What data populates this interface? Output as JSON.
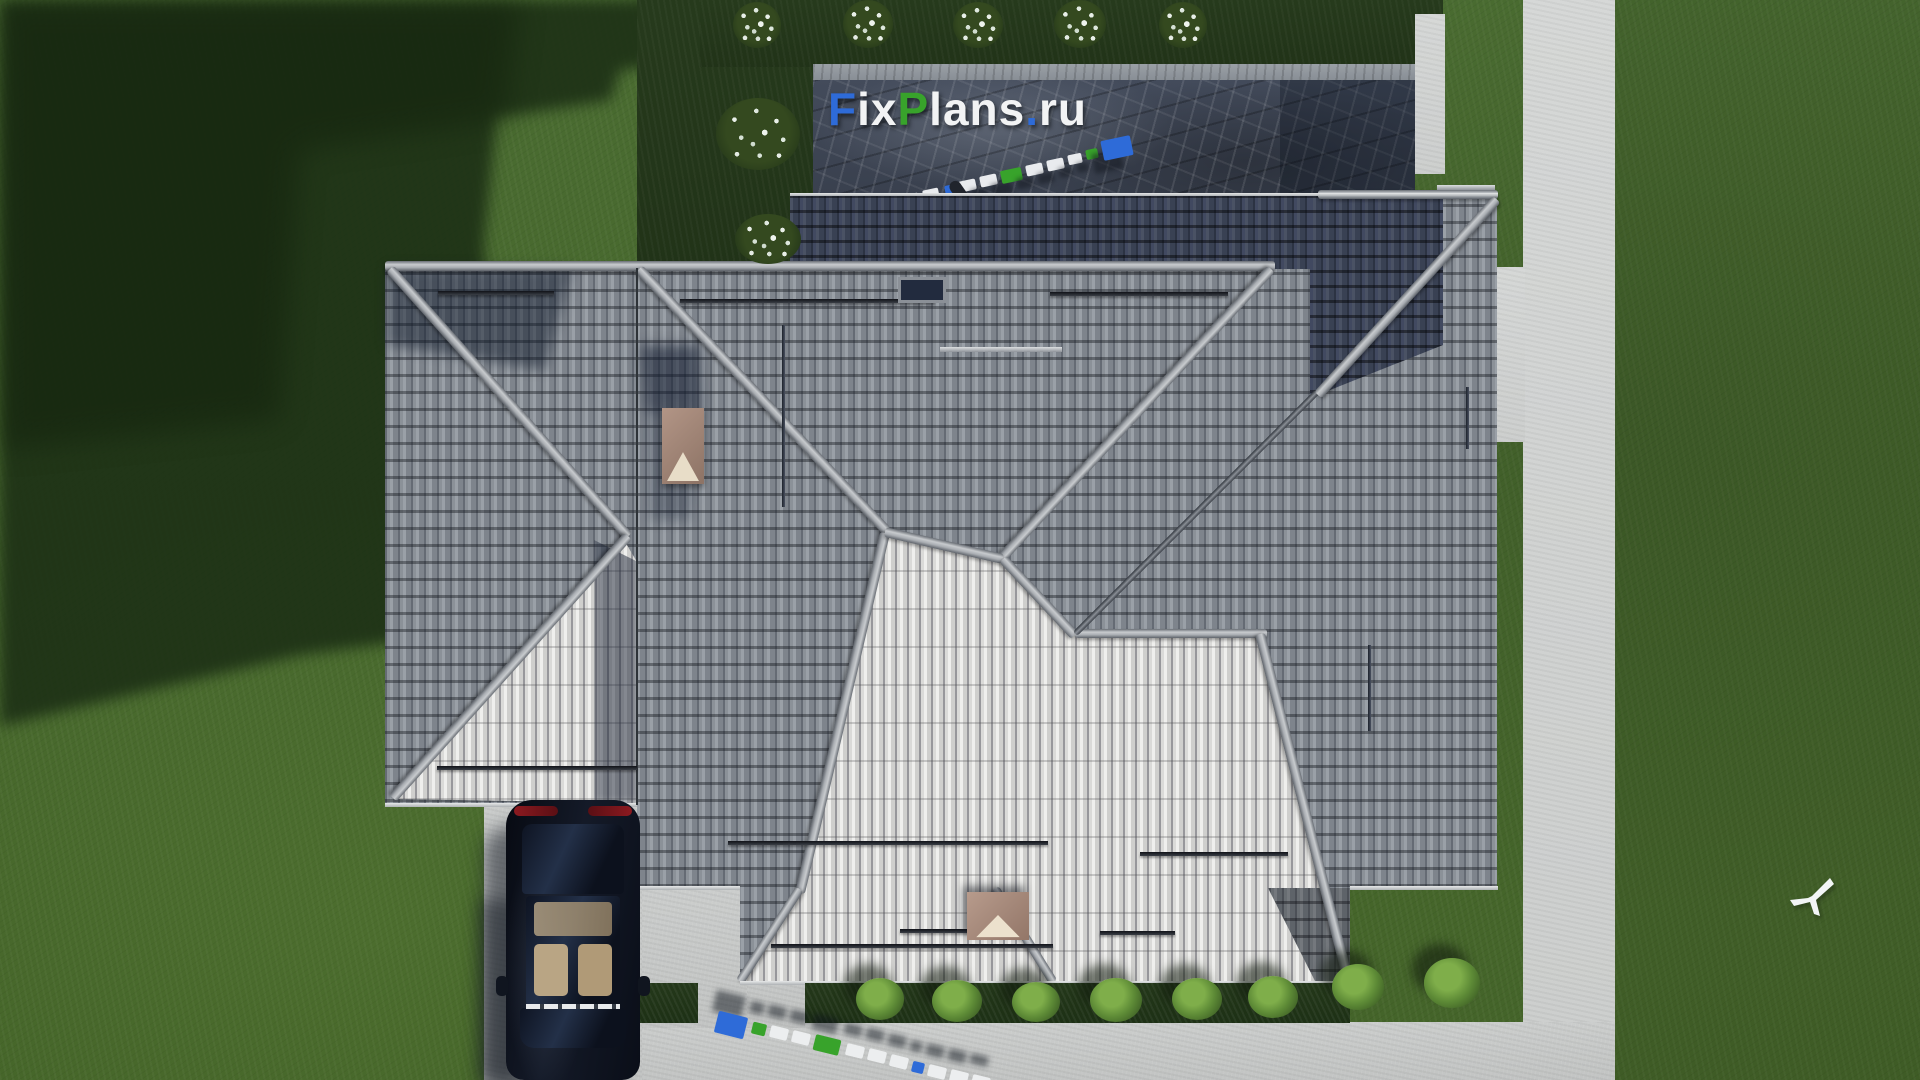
{
  "scene": {
    "description": "Aerial top-down 3D architectural render of a house with grey hipped tile roof, lawn, terrace, driveway with parked car and FixPlans.ru watermarks",
    "width": 1920,
    "height": 1080
  },
  "watermark": {
    "text": "FixPlans.ru",
    "segments": [
      {
        "text": "F",
        "style": "color:#2e6bd8"
      },
      {
        "text": "ix",
        "style": "color:#f2f3f4"
      },
      {
        "text": "P",
        "style": "color:#38a32b"
      },
      {
        "text": "lans",
        "style": "color:#f2f3f4"
      },
      {
        "text": ".",
        "style": "color:#2e6bd8"
      },
      {
        "text": "ru",
        "style": "color:#f2f3f4"
      }
    ]
  },
  "palette": {
    "grass": "#4a6c31",
    "grass_shadow": "#1c2f15",
    "roof_bright": "#d8d8d6",
    "roof_medium": "#858b93",
    "roof_dark_shadow": "#39415 3",
    "ridge_cap": "#b0b4b8",
    "terrace_stone": "#3d4452",
    "concrete": "#c8cac9",
    "hedge": "#22351a",
    "shrub": "#6d9c42",
    "car_body": "#0d1220",
    "car_interior": "#b9a584",
    "taillight": "#8c1a20",
    "chimney": "#a08274",
    "chimney_cap_inner": "#e8ddc8",
    "watermark_blue": "#2e6bd8",
    "watermark_green": "#38a32b",
    "watermark_white": "#eceeef"
  }
}
